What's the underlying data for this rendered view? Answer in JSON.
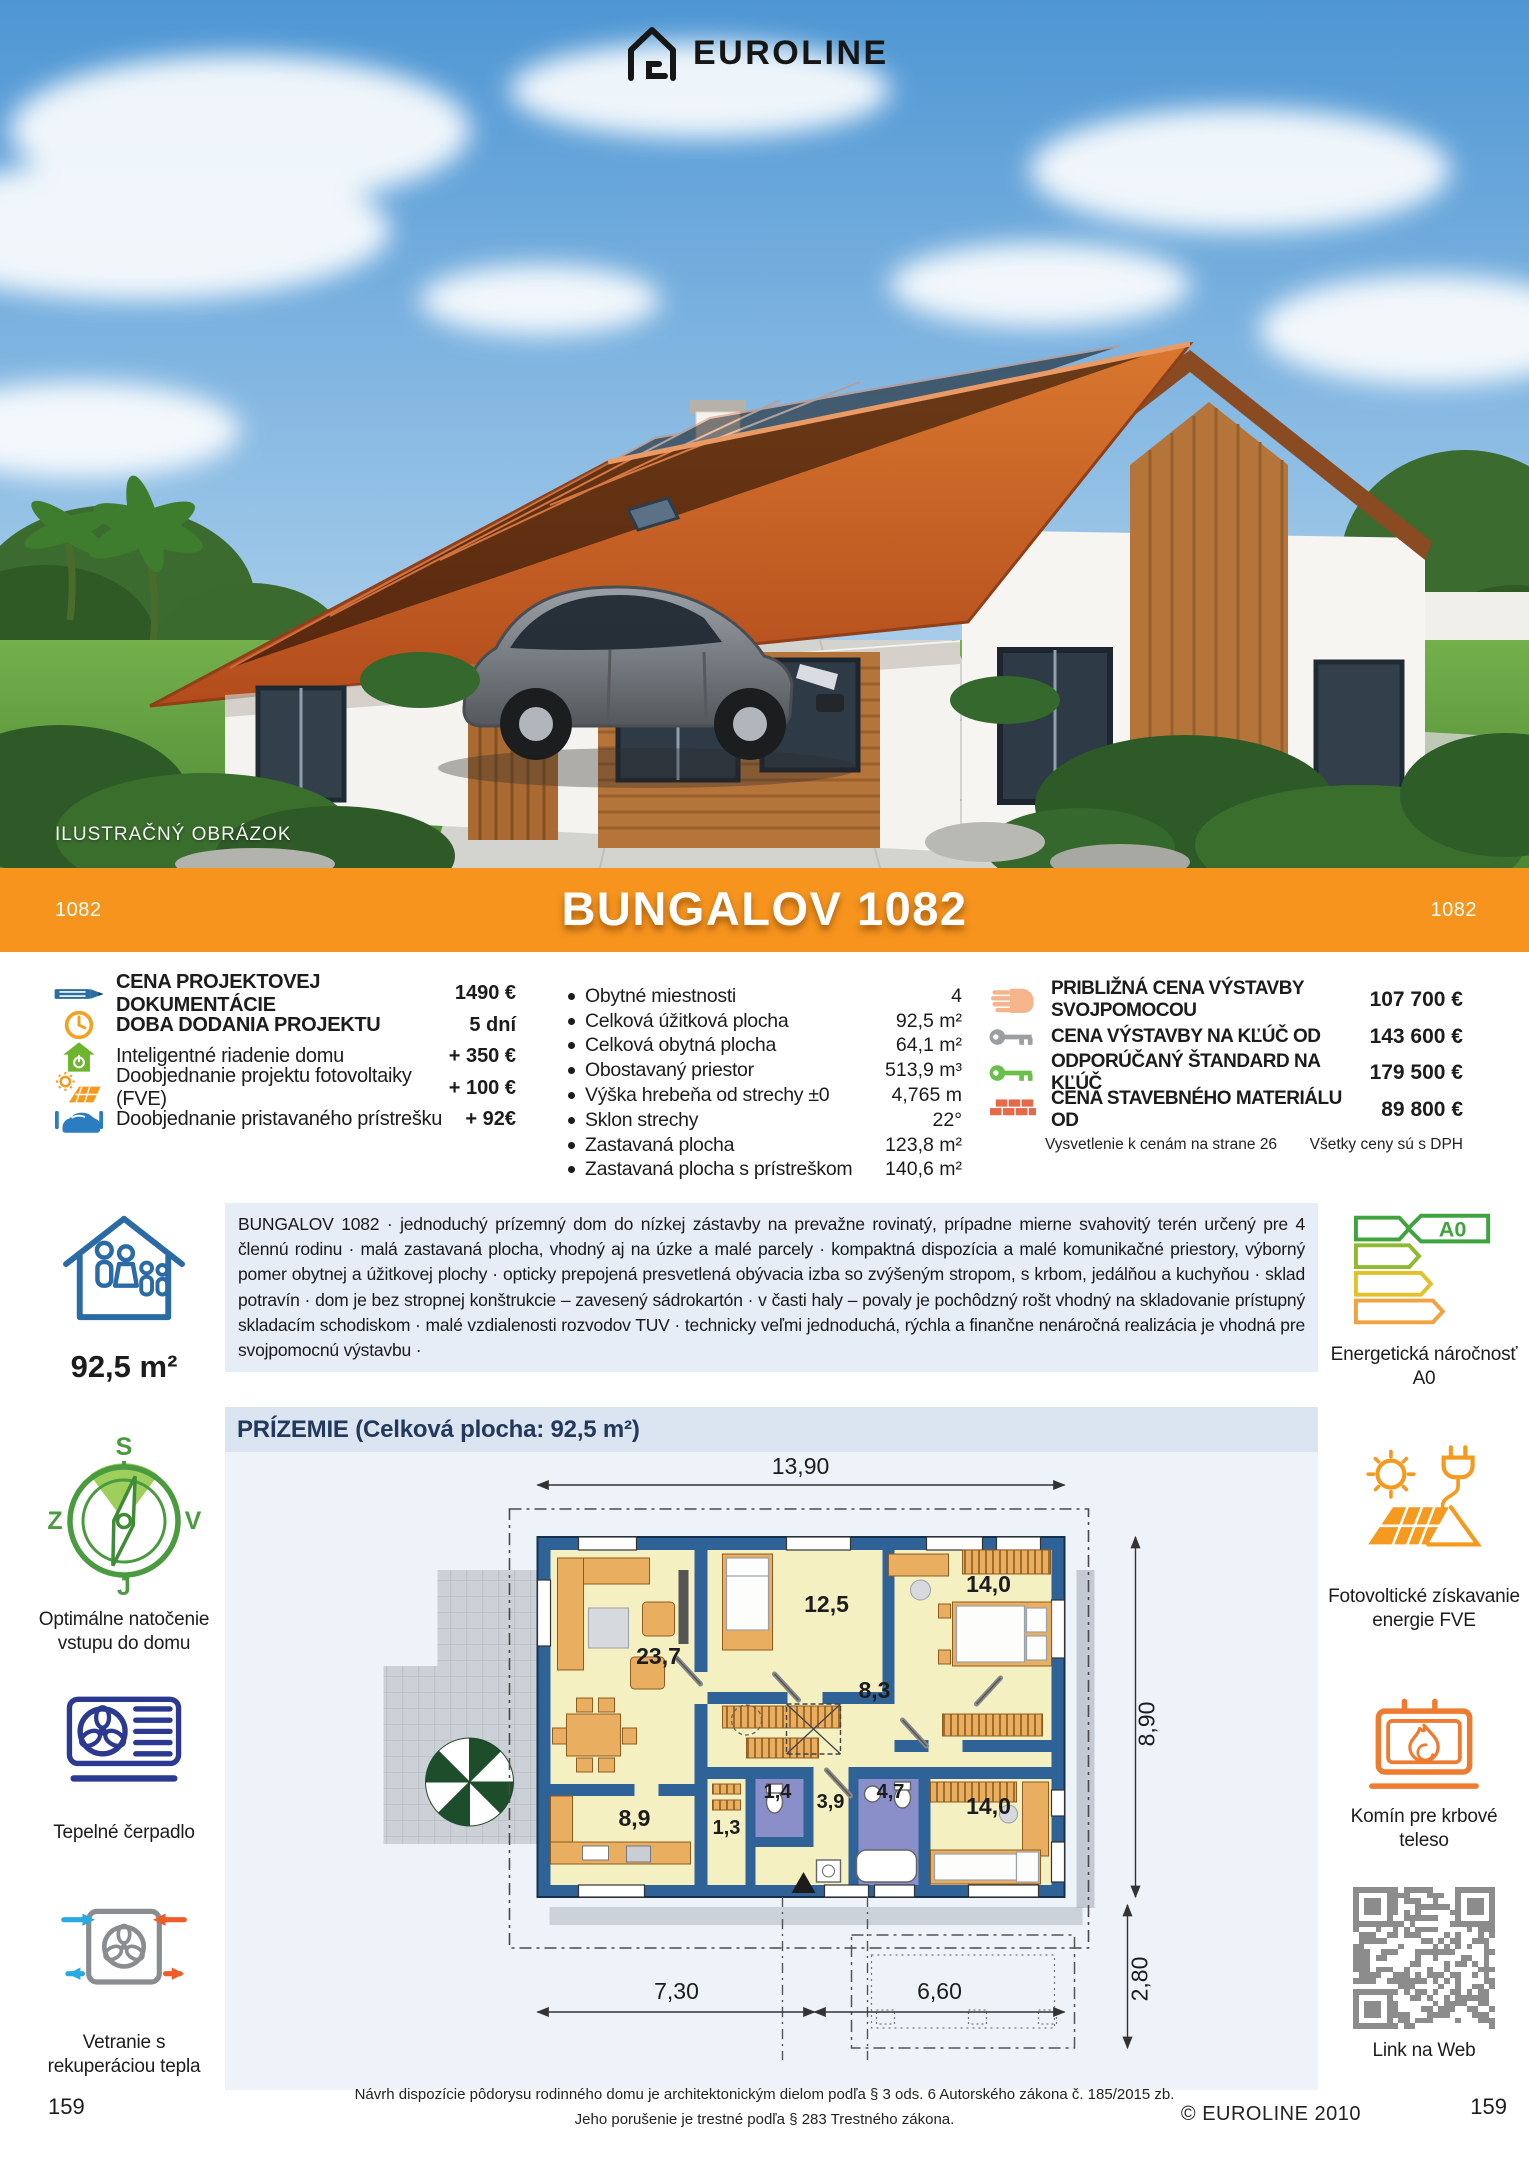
{
  "colors": {
    "accent_orange": "#F6941E",
    "wall_blue": "#2F6398",
    "icon_blue": "#2B6CA3",
    "icon_green": "#6CB52D",
    "icon_navy": "#2B3990",
    "icon_gray": "#8A8D90",
    "brick_red": "#E8684A",
    "hand_peach": "#F5B48A",
    "key_green": "#6ABF4B",
    "energy_green": "#3FA33F"
  },
  "header": {
    "brand": "EUROLINE",
    "illustration_note": "ILUSTRAČNÝ OBRÁZOK"
  },
  "banner": {
    "title": "BUNGALOV 1082",
    "code_left": "1082",
    "code_right": "1082"
  },
  "specs_left": {
    "rows": [
      {
        "icon": "pencil-icon",
        "label": "CENA PROJEKTOVEJ DOKUMENTÁCIE",
        "value": "1490 €"
      },
      {
        "icon": "clock-icon",
        "label": "DOBA DODANIA PROJEKTU",
        "value": "5 dní"
      },
      {
        "icon": "smart-home-icon",
        "label": "Inteligentné riadenie domu",
        "value": "+ 350 €"
      },
      {
        "icon": "solar-panel-icon",
        "label": "Doobjednanie projektu fotovoltaiky (FVE)",
        "value": "+ 100 €"
      },
      {
        "icon": "carport-icon",
        "label": "Doobjednanie pristavaného prístrešku",
        "value": "+ 92€"
      }
    ]
  },
  "specs_middle": {
    "rows": [
      {
        "label": "Obytné miestnosti",
        "value": "4"
      },
      {
        "label": "Celková úžitková plocha",
        "value": "92,5 m²"
      },
      {
        "label": "Celková obytná plocha",
        "value": "64,1 m²"
      },
      {
        "label": "Obostavaný priestor",
        "value": "513,9 m³"
      },
      {
        "label": "Výška hrebeňa od strechy ±0",
        "value": "4,765 m"
      },
      {
        "label": "Sklon strechy",
        "value": "22°"
      },
      {
        "label": "Zastavaná plocha",
        "value": "123,8 m²"
      },
      {
        "label": "Zastavaná plocha s prístreškom",
        "value": "140,6 m²"
      }
    ]
  },
  "specs_right": {
    "rows": [
      {
        "icon": "hand-icon",
        "label": "PRIBLIŽNÁ CENA VÝSTAVBY SVOJPOMOCOU",
        "value": "107 700 €"
      },
      {
        "icon": "key-gray-icon",
        "label": "CENA VÝSTAVBY NA KĽÚČ OD",
        "value": "143 600 €"
      },
      {
        "icon": "key-green-icon",
        "label": "ODPORÚČANÝ ŠTANDARD NA KĽÚČ",
        "value": "179 500 €"
      },
      {
        "icon": "bricks-icon",
        "label": "CENA STAVEBNÉHO MATERIÁLU OD",
        "value": "89 800 €"
      }
    ],
    "note_left": "Vysvetlenie k cenám na strane 26",
    "note_right": "Všetky ceny sú s DPH"
  },
  "description": {
    "text": "BUNGALOV 1082 · jednoduchý prízemný dom do nízkej zástavby na prevažne rovinatý, prípadne mierne svahovitý terén určený pre 4 člennú rodinu · malá zastavaná plocha, vhodný aj na úzke a malé parcely · kompaktná dispozícia a malé komunikačné priestory, výborný pomer obytnej a úžitkovej plochy · opticky prepojená presvetlená obývacia izba so zvýšeným stropom, s krbom, jedálňou a kuchyňou · sklad potravín ·  dom je bez stropnej konštrukcie – zavesený sádrokartón · v časti haly – povaly je pochôdzný rošt vhodný na skladovanie prístupný skladacím schodiskom · malé vzdialenosti rozvodov TUV · technicky veľmi jednoduchá, rýchla a finančne nenáročná realizácia je vhodná pre svojpomocnú výstavbu ·"
  },
  "sidebar_left": {
    "area": "92,5 m²",
    "compass": {
      "n": "S",
      "e": "V",
      "s": "J",
      "w": "Z",
      "caption": "Optimálne natočenie vstupu do domu"
    },
    "heat_pump_caption": "Tepelné čerpadlo",
    "ventilation_caption": "Vetranie s rekuperáciou tepla"
  },
  "sidebar_right": {
    "energy_label": "A0",
    "energy_caption": "Energetická náročnosť A0",
    "pv_caption": "Fotovoltické získavanie energie FVE",
    "fireplace_caption": "Komín pre krbové teleso",
    "qr_caption": "Link na Web"
  },
  "floorplan": {
    "title": "PRÍZEMIE (Celková plocha: 92,5 m²)",
    "dim_top": "13,90",
    "dim_right": "8,90",
    "dim_right2": "2,80",
    "dim_bottom_left": "7,30",
    "dim_bottom_right": "6,60",
    "rooms": {
      "living": "23,7",
      "bedroom_top": "12,5",
      "bedroom_right": "14,0",
      "hall": "8,3",
      "wc": "1,4",
      "corridor": "3,9",
      "bath": "4,7",
      "kitchen": "8,9",
      "pantry": "1,3",
      "bedroom_bottom": "14,0"
    }
  },
  "footer": {
    "line1": "Návrh dispozície pôdorysu rodinného domu je architektonickým dielom podľa § 3 ods. 6 Autorského zákona č. 185/2015 zb.",
    "line2": "Jeho porušenie je trestné podľa § 283 Trestného zákona.",
    "copyright": "© EUROLINE 2010",
    "page_left": "159",
    "page_right": "159"
  }
}
